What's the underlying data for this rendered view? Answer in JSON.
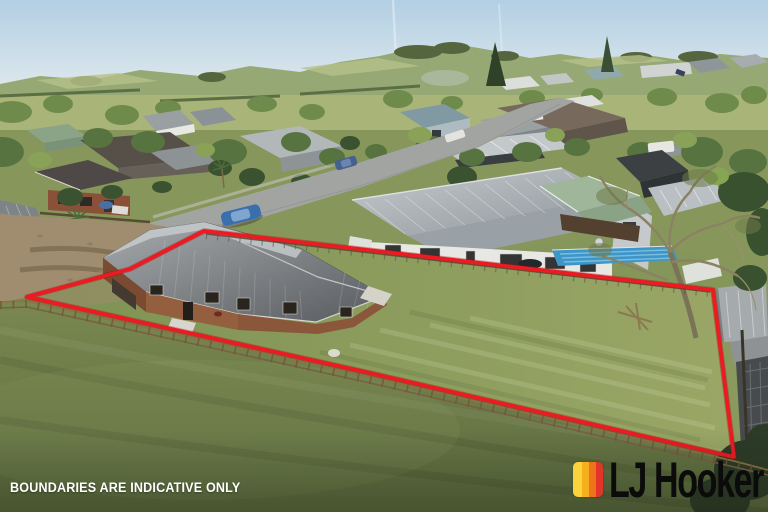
{
  "watermark": {
    "text": "BOUNDARIES ARE INDICATIVE ONLY",
    "color": "#FFFFFF"
  },
  "brand": {
    "wordmark": "LJ Hooker",
    "wordmark_color": "#0B0B0B",
    "stripe_colors": [
      "#F9D23C",
      "#F5B11D",
      "#EE731A",
      "#E1352A"
    ]
  },
  "boundary": {
    "color": "#EC1B22",
    "style": "solid",
    "corners": [
      [
        27,
        297
      ],
      [
        130,
        269
      ],
      [
        204,
        231
      ],
      [
        713,
        290
      ],
      [
        734,
        457
      ],
      [
        370,
        373
      ]
    ]
  }
}
